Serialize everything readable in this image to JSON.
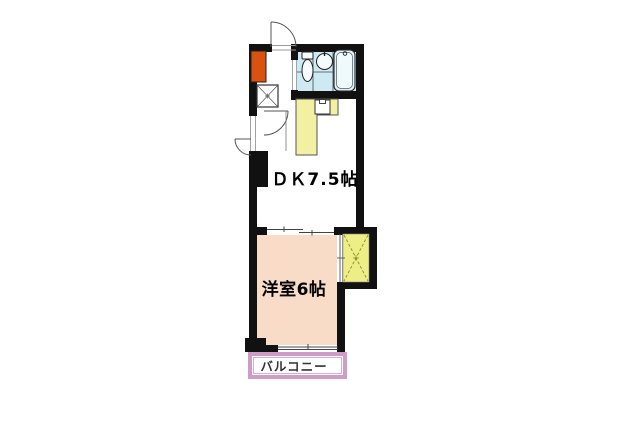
{
  "plan": {
    "type": "floor-plan",
    "rooms": {
      "dk": {
        "label": "ＤＫ7.5帖",
        "name": "dining-kitchen",
        "size_tatami": 7.5,
        "floor_fill": "#ffffff"
      },
      "western_room": {
        "label": "洋室6帖",
        "name": "western-style-room",
        "size_tatami": 6,
        "floor_fill": "#f8dcc8"
      },
      "balcony": {
        "label": "バルコニー",
        "name": "balcony",
        "border_color": "#cf9cc8"
      }
    },
    "fixtures": [
      "entrance-door",
      "shoe-cabinet",
      "washing-machine-space",
      "interior-door",
      "service-hatch",
      "unit-bath",
      "toilet",
      "wash-basin",
      "bathtub",
      "kitchen-counter",
      "kitchen-sink",
      "closet",
      "sliding-door",
      "balcony-window"
    ],
    "colors": {
      "wall": "#111111",
      "bathroom_floor": "#cdeaf2",
      "bathtub_fill": "#dff2f8",
      "kitchen_counter": "#f2f0a2",
      "closet_fill": "#eeee86",
      "western_room_fill": "#f8dcc8",
      "balcony_border": "#cf9cc8",
      "shoe_cabinet": "#d9530f"
    }
  }
}
